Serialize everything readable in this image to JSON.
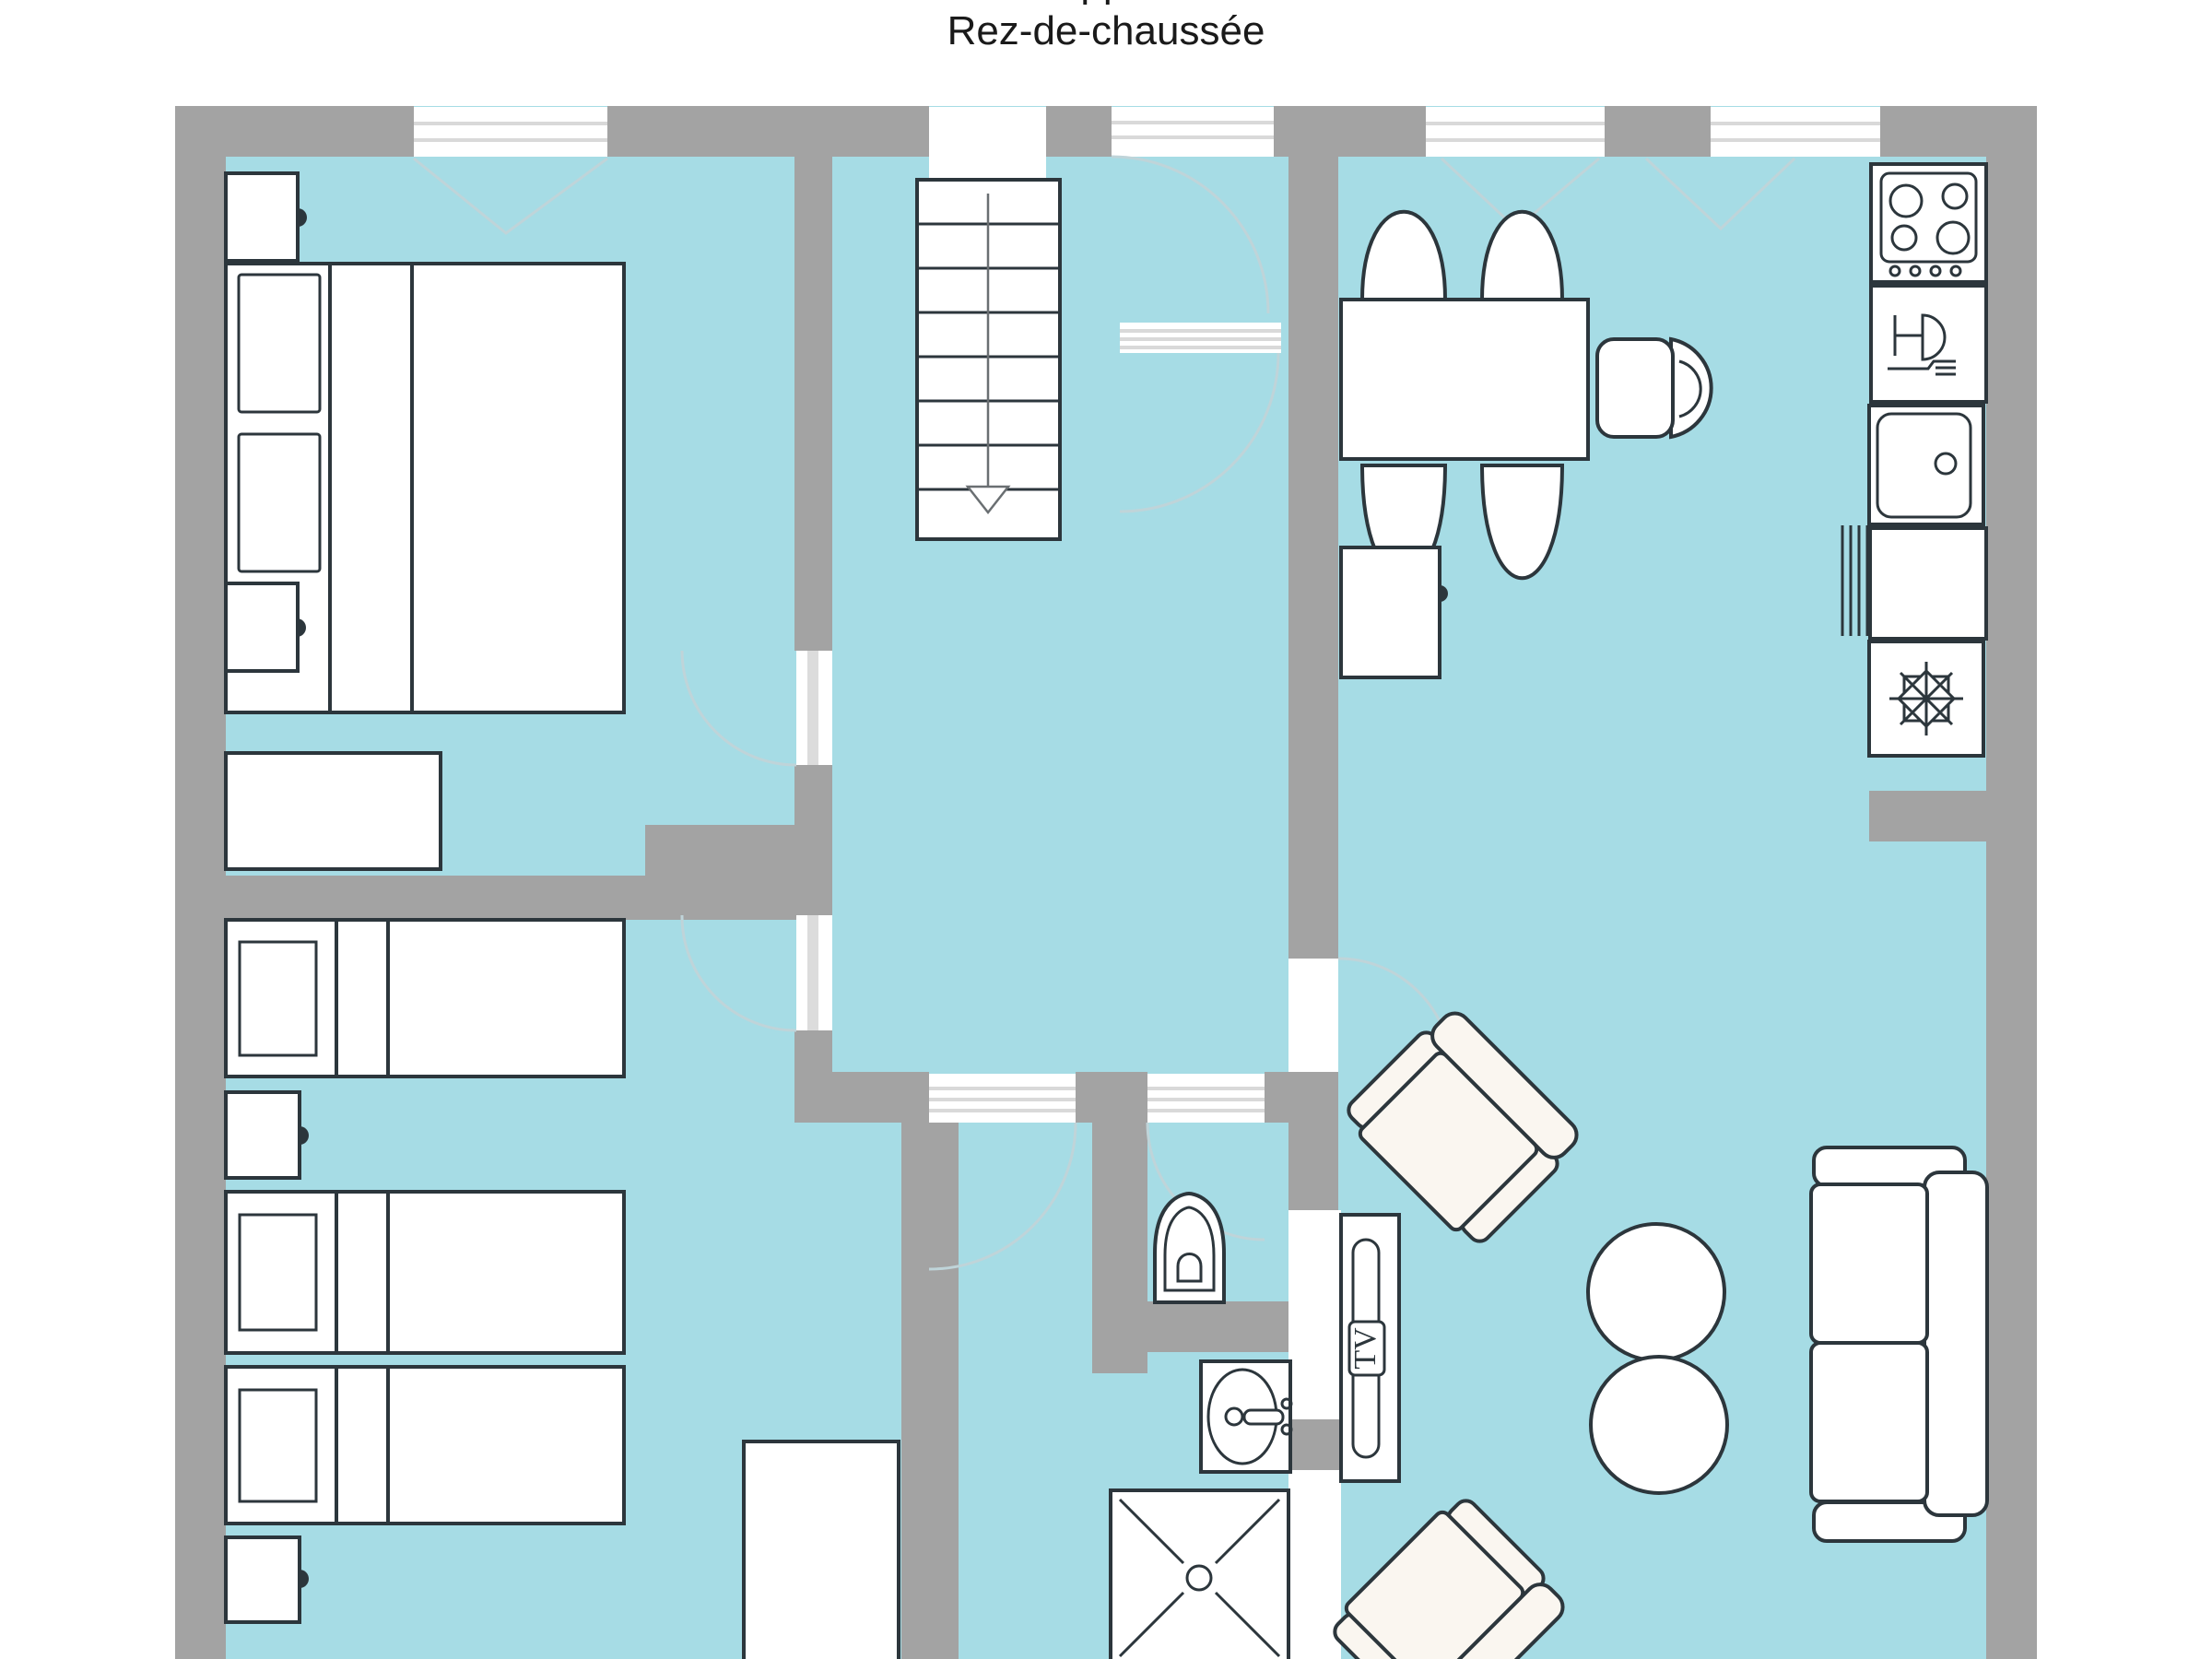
{
  "title": {
    "line1_clipped": "Plan de l'appartement 2",
    "line2": "Rez-de-chaussée"
  },
  "labels": {
    "tv": "TV"
  },
  "colors": {
    "floor": "#a6dce5",
    "wall": "#a3a3a3",
    "ink": "#2c363c",
    "soft": "#faf6f0",
    "faint": "#bfd4d9",
    "stripe": "#d9d9d9",
    "text": "#1a1a1a"
  },
  "floorplan": {
    "floor_name": "Rez-de-chaussée (ground floor)",
    "rooms": [
      {
        "name": "bedroom-1",
        "furniture": [
          "double-bed",
          "nightstand",
          "nightstand",
          "dresser"
        ]
      },
      {
        "name": "bedroom-2",
        "furniture": [
          "single-bed",
          "single-bed",
          "single-bed",
          "nightstand",
          "nightstand",
          "wardrobe"
        ]
      },
      {
        "name": "hallway",
        "furniture": [
          "staircase-down"
        ]
      },
      {
        "name": "bathroom",
        "furniture": [
          "washbasin",
          "shower"
        ]
      },
      {
        "name": "wc",
        "furniture": [
          "toilet"
        ]
      },
      {
        "name": "kitchen",
        "furniture": [
          "cooktop",
          "dishwasher",
          "sink",
          "counter",
          "fridge-freezer"
        ]
      },
      {
        "name": "dining-area",
        "furniture": [
          "dining-table",
          "chair",
          "chair",
          "chair",
          "chair",
          "armchair-round",
          "sideboard"
        ]
      },
      {
        "name": "living-area",
        "furniture": [
          "armchair",
          "armchair",
          "round-table",
          "round-table",
          "tv-unit",
          "sofa"
        ]
      }
    ],
    "icons": [
      "snowflake-icon",
      "dishwasher-glass-fork-icon",
      "stairs-down-arrow-icon",
      "shower-cross-icon"
    ]
  }
}
